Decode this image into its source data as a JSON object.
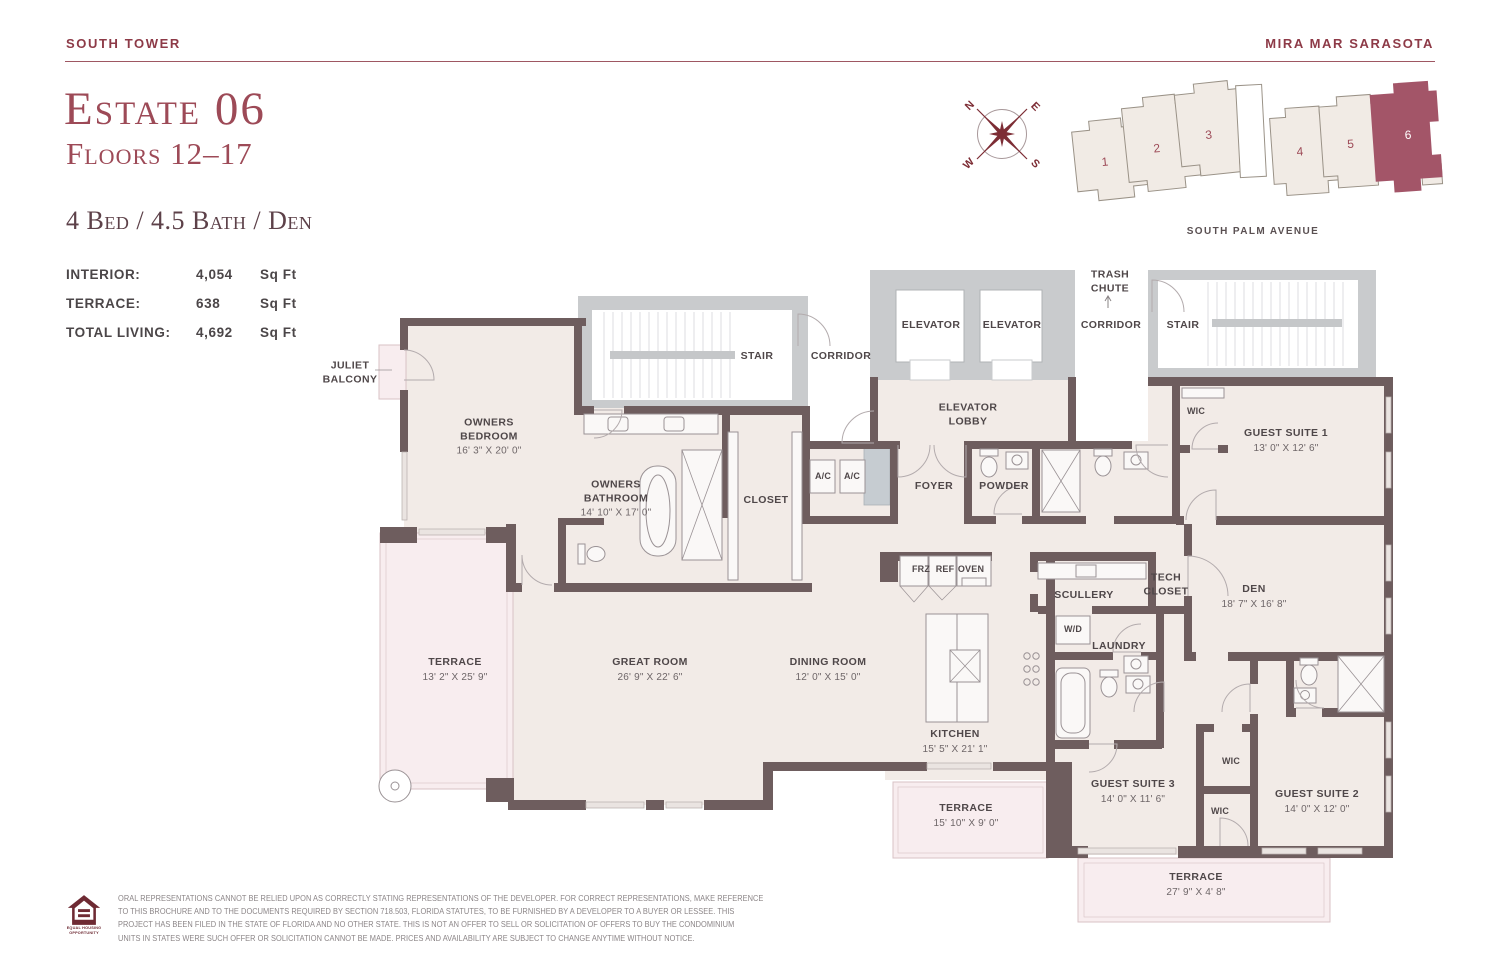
{
  "header": {
    "left": "SOUTH TOWER",
    "right": "MIRA MAR SARASOTA"
  },
  "title": {
    "estate": "Estate 06",
    "floors": "Floors 12–17",
    "specs": "4 Bed / 4.5 Bath / Den"
  },
  "stats": [
    {
      "label": "INTERIOR:",
      "value": "4,054",
      "unit": "Sq Ft"
    },
    {
      "label": "TERRACE:",
      "value": "638",
      "unit": "Sq Ft"
    },
    {
      "label": "TOTAL LIVING:",
      "value": "4,692",
      "unit": "Sq Ft"
    }
  ],
  "compass": {
    "n": "N",
    "e": "E",
    "s": "S",
    "w": "W"
  },
  "locator": {
    "street": "SOUTH PALM AVENUE",
    "buildings": [
      {
        "num": "1"
      },
      {
        "num": "2"
      },
      {
        "num": "3"
      },
      {
        "num": "4"
      },
      {
        "num": "5"
      },
      {
        "num": "6",
        "highlighted": true
      }
    ],
    "highlight_color": "#a35568"
  },
  "colors": {
    "accent_maroon": "#8d3a47",
    "title_maroon": "#9d4a57",
    "wall": "#6e5d5e",
    "floor": "#f2ebe7",
    "terrace": "#f8edef",
    "common_gray": "#c9cbcd"
  },
  "plan": {
    "labels": [
      {
        "id": "stair-left",
        "text": "STAIR",
        "x": 757,
        "y": 357
      },
      {
        "id": "corridor-left",
        "text": "CORRIDOR",
        "x": 841,
        "y": 357
      },
      {
        "id": "elevator-1",
        "text": "ELEVATOR",
        "x": 931,
        "y": 326
      },
      {
        "id": "elevator-2",
        "text": "ELEVATOR",
        "x": 1012,
        "y": 326
      },
      {
        "id": "elevator-lobby",
        "text": "ELEVATOR\nLOBBY",
        "x": 968,
        "y": 415
      },
      {
        "id": "trash-chute",
        "text": "TRASH\nCHUTE",
        "x": 1110,
        "y": 282
      },
      {
        "id": "corridor-right",
        "text": "CORRIDOR",
        "x": 1111,
        "y": 326
      },
      {
        "id": "stair-right",
        "text": "STAIR",
        "x": 1183,
        "y": 326
      },
      {
        "id": "juliet-balcony",
        "text": "JULIET\nBALCONY",
        "x": 350,
        "y": 373
      },
      {
        "id": "owners-bedroom",
        "text": "OWNERS\nBEDROOM",
        "dims": "16' 3\" X 20' 0\"",
        "x": 489,
        "y": 437
      },
      {
        "id": "owners-bathroom",
        "text": "OWNERS\nBATHROOM",
        "dims": "14' 10\" X 17' 0\"",
        "x": 616,
        "y": 499
      },
      {
        "id": "closet",
        "text": "CLOSET",
        "x": 766,
        "y": 501
      },
      {
        "id": "ac-1",
        "text": "A/C",
        "size": "sm",
        "x": 823,
        "y": 477
      },
      {
        "id": "ac-2",
        "text": "A/C",
        "size": "sm",
        "x": 852,
        "y": 477
      },
      {
        "id": "foyer",
        "text": "FOYER",
        "x": 934,
        "y": 487
      },
      {
        "id": "powder",
        "text": "POWDER",
        "x": 1004,
        "y": 487
      },
      {
        "id": "wic-gs1",
        "text": "WIC",
        "size": "sm",
        "x": 1196,
        "y": 412
      },
      {
        "id": "guest-suite-1",
        "text": "GUEST SUITE 1",
        "dims": "13' 0\" X 12' 6\"",
        "x": 1286,
        "y": 441
      },
      {
        "id": "frz",
        "text": "FRZ",
        "size": "sm",
        "x": 921,
        "y": 570
      },
      {
        "id": "ref",
        "text": "REF",
        "size": "sm",
        "x": 945,
        "y": 570
      },
      {
        "id": "oven",
        "text": "OVEN",
        "size": "sm",
        "x": 971,
        "y": 570
      },
      {
        "id": "scullery",
        "text": "SCULLERY",
        "x": 1084,
        "y": 596
      },
      {
        "id": "tech-closet",
        "text": "TECH\nCLOSET",
        "x": 1166,
        "y": 585
      },
      {
        "id": "den",
        "text": "DEN",
        "dims": "18' 7\" X 16' 8\"",
        "x": 1254,
        "y": 597
      },
      {
        "id": "wd",
        "text": "W/D",
        "size": "sm",
        "x": 1073,
        "y": 630
      },
      {
        "id": "laundry",
        "text": "LAUNDRY",
        "x": 1119,
        "y": 647
      },
      {
        "id": "terrace-left",
        "text": "TERRACE",
        "dims": "13' 2\" X 25' 9\"",
        "x": 455,
        "y": 670
      },
      {
        "id": "great-room",
        "text": "GREAT ROOM",
        "dims": "26' 9\" X 22' 6\"",
        "x": 650,
        "y": 670
      },
      {
        "id": "dining-room",
        "text": "DINING ROOM",
        "dims": "12' 0\" X 15' 0\"",
        "x": 828,
        "y": 670
      },
      {
        "id": "kitchen",
        "text": "KITCHEN",
        "dims": "15' 5\" X 21' 1\"",
        "x": 955,
        "y": 742
      },
      {
        "id": "terrace-kitchen",
        "text": "TERRACE",
        "dims": "15' 10\" X 9' 0\"",
        "x": 966,
        "y": 816
      },
      {
        "id": "guest-suite-3",
        "text": "GUEST SUITE 3",
        "dims": "14' 0\" X 11' 6\"",
        "x": 1133,
        "y": 792
      },
      {
        "id": "wic-1",
        "text": "WIC",
        "size": "sm",
        "x": 1231,
        "y": 762
      },
      {
        "id": "wic-2",
        "text": "WIC",
        "size": "sm",
        "x": 1220,
        "y": 812
      },
      {
        "id": "guest-suite-2",
        "text": "GUEST SUITE 2",
        "dims": "14' 0\" X 12' 0\"",
        "x": 1317,
        "y": 802
      },
      {
        "id": "terrace-bottom",
        "text": "TERRACE",
        "dims": "27' 9\" X 4' 8\"",
        "x": 1196,
        "y": 885
      }
    ]
  },
  "footer": {
    "logo_line1": "EQUAL HOUSING",
    "logo_line2": "OPPORTUNITY",
    "lines": [
      "ORAL REPRESENTATIONS CANNOT BE RELIED UPON AS CORRECTLY STATING REPRESENTATIONS OF THE DEVELOPER. FOR CORRECT REPRESENTATIONS, MAKE REFERENCE",
      "TO THIS BROCHURE AND TO THE DOCUMENTS REQUIRED BY SECTION 718.503, FLORIDA STATUTES, TO BE FURNISHED BY A DEVELOPER TO A BUYER OR LESSEE. THIS",
      "PROJECT HAS BEEN FILED IN THE STATE OF FLORIDA AND NO OTHER STATE. THIS IS NOT AN OFFER TO SELL OR SOLICITATION OF OFFERS TO BUY THE CONDOMINIUM",
      "UNITS IN STATES WERE SUCH OFFER OR SOLICITATION CANNOT BE MADE. PRICES AND AVAILABILITY ARE SUBJECT TO CHANGE ANYTIME WITHOUT NOTICE."
    ]
  }
}
